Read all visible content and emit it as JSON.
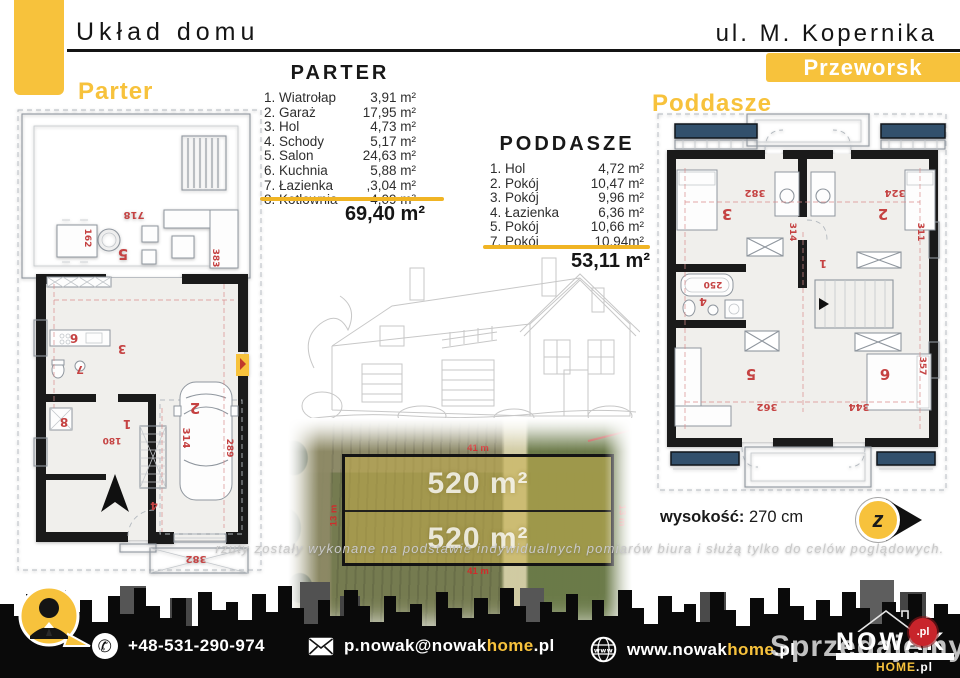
{
  "header": {
    "title": "Układ domu",
    "address": "ul. M. Kopernika",
    "city_badge": "Przeworsk"
  },
  "plan_labels": {
    "ground": "Parter",
    "attic": "Poddasze"
  },
  "area_lists": {
    "parter": {
      "heading": "PARTER",
      "rows": [
        {
          "name": "1. Wiatrołap",
          "area": "3,91 m²"
        },
        {
          "name": "2. Garaż",
          "area": "17,95 m²"
        },
        {
          "name": "3. Hol",
          "area": "4,73 m²"
        },
        {
          "name": "4. Schody",
          "area": "5,17 m²"
        },
        {
          "name": "5. Salon",
          "area": "24,63 m²"
        },
        {
          "name": "6. Kuchnia",
          "area": "5,88 m²"
        },
        {
          "name": "7. Łazienka",
          "area": ",3,04 m²"
        },
        {
          "name": "8. Kotłownia",
          "area": "4,09 m²"
        }
      ],
      "total": "69,40 m²"
    },
    "poddasze": {
      "heading": "PODDASZE",
      "rows": [
        {
          "name": "1. Hol",
          "area": "4,72 m²"
        },
        {
          "name": "2. Pokój",
          "area": "10,47 m²"
        },
        {
          "name": "3. Pokój",
          "area": "9,96 m²"
        },
        {
          "name": "4. Łazienka",
          "area": "6,36 m²"
        },
        {
          "name": "5. Pokój",
          "area": "10,66 m²"
        },
        {
          "name": "7. Pokój",
          "area": "10,94m²"
        }
      ],
      "total": "53,11 m²"
    }
  },
  "parter_plan": {
    "room_numbers": {
      "wiatrolap": "1",
      "garaz": "2",
      "hol": "3",
      "schody": "4",
      "salon": "5",
      "kuchnia": "6",
      "lazienka": "7",
      "kotlownia": "8"
    },
    "dims": [
      "718",
      "382",
      "180",
      "314",
      "289",
      "383",
      "162"
    ]
  },
  "poddasze_plan": {
    "room_numbers": {
      "hol": "1",
      "pokoj2": "2",
      "pokoj3": "3",
      "lazienka": "4",
      "pokoj5": "5",
      "pokoj6": "6"
    },
    "dims": [
      "382",
      "324",
      "314",
      "311",
      "250",
      "362",
      "344",
      "357"
    ]
  },
  "plot": {
    "upper_area": "520 m²",
    "lower_area": "520 m²",
    "width_dim": "41 m",
    "side_dim": "13 m"
  },
  "height_note": {
    "label": "wysokość:",
    "value": "270 cm"
  },
  "next_button": {
    "glyph": "z"
  },
  "disclaimer": "rzuty zostały wykonane na podstawie indywidualnych pomiarów biura i służą tylko do celów poglądowych.",
  "footer": {
    "phone": "+48-531-290-974",
    "email": {
      "prefix": "p.nowak@nowak",
      "highlight": "home",
      "suffix": ".pl"
    },
    "website": {
      "prefix": "www.nowak",
      "highlight": "home",
      "suffix": ".pl"
    },
    "logo": {
      "name": "NOWAK",
      "home": "HOME",
      "tld": ".pl"
    },
    "watermark": {
      "text": "Sprzedajemy",
      "badge": ".pl"
    }
  },
  "colors": {
    "accent": "#F7C23C",
    "underline": "#F0B424",
    "plan_red": "#C54242",
    "roof_window_navy": "#32506C",
    "watermark_red": "#C8242B"
  }
}
